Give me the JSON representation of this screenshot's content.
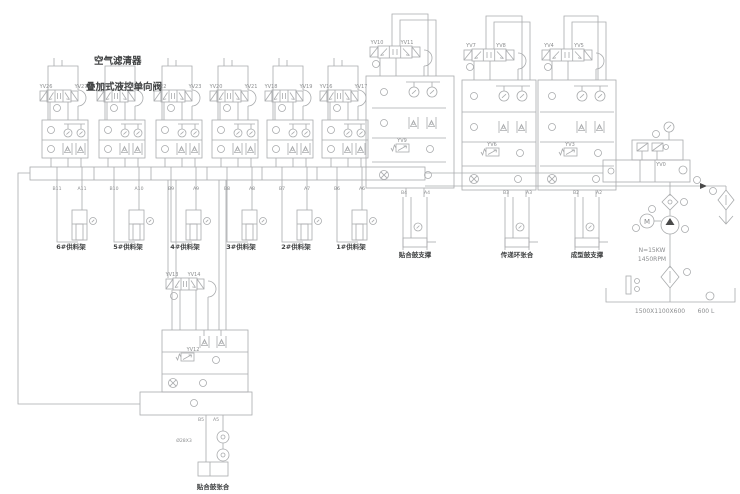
{
  "colors": {
    "background": "#ffffff",
    "line": "#a9abad",
    "text_light": "#8b8d8f",
    "text_dark": "#3f4142"
  },
  "titles": {
    "air_filter": "空气滤清器",
    "stacked_pilot_check_valve": "叠加式液控单向阀"
  },
  "supply_stations": [
    {
      "yv_left": "YV26",
      "yv_right": "YV27",
      "port_b": "B11",
      "port_a": "A11",
      "cylinder_label": "6#供料架"
    },
    {
      "yv_left": "YV24",
      "yv_right": "YV25",
      "port_b": "B10",
      "port_a": "A10",
      "cylinder_label": "5#供料架"
    },
    {
      "yv_left": "YV22",
      "yv_right": "YV23",
      "port_b": "B9",
      "port_a": "A9",
      "cylinder_label": "4#供料架"
    },
    {
      "yv_left": "YV20",
      "yv_right": "YV21",
      "port_b": "B8",
      "port_a": "A8",
      "cylinder_label": "3#供料架"
    },
    {
      "yv_left": "YV18",
      "yv_right": "YV19",
      "port_b": "B7",
      "port_a": "A7",
      "cylinder_label": "2#供料架"
    },
    {
      "yv_left": "YV16",
      "yv_right": "YV17",
      "port_b": "B6",
      "port_a": "A6",
      "cylinder_label": "1#供料架"
    }
  ],
  "main_stations": [
    {
      "yv_left": "YV10",
      "yv_right": "YV11",
      "yv_inner": "YV9",
      "port_b": "B4",
      "port_a": "A4",
      "cylinder_label": "贴合鼓支撑"
    },
    {
      "yv_left": "YV7",
      "yv_right": "YV8",
      "yv_inner": "YV6",
      "port_b": "B3",
      "port_a": "A3",
      "cylinder_label": "传递环张合"
    },
    {
      "yv_left": "YV4",
      "yv_right": "YV5",
      "yv_inner": "YV3",
      "port_b": "B2",
      "port_a": "A2",
      "cylinder_label": "成型鼓支撑"
    }
  ],
  "bottom_station": {
    "yv_left": "YV13",
    "yv_right": "YV14",
    "yv_inner": "YV12",
    "port_b": "B5",
    "port_a": "A5",
    "pipe_label": "Ø28X3",
    "cylinder_label": "贴合鼓张合"
  },
  "power_unit": {
    "unload_valve": "YV0",
    "motor_label": "M",
    "motor_power": "N=15KW",
    "motor_speed": "1450RPM",
    "tank_dimensions": "1500X1100X600",
    "tank_volume": "600 L"
  }
}
